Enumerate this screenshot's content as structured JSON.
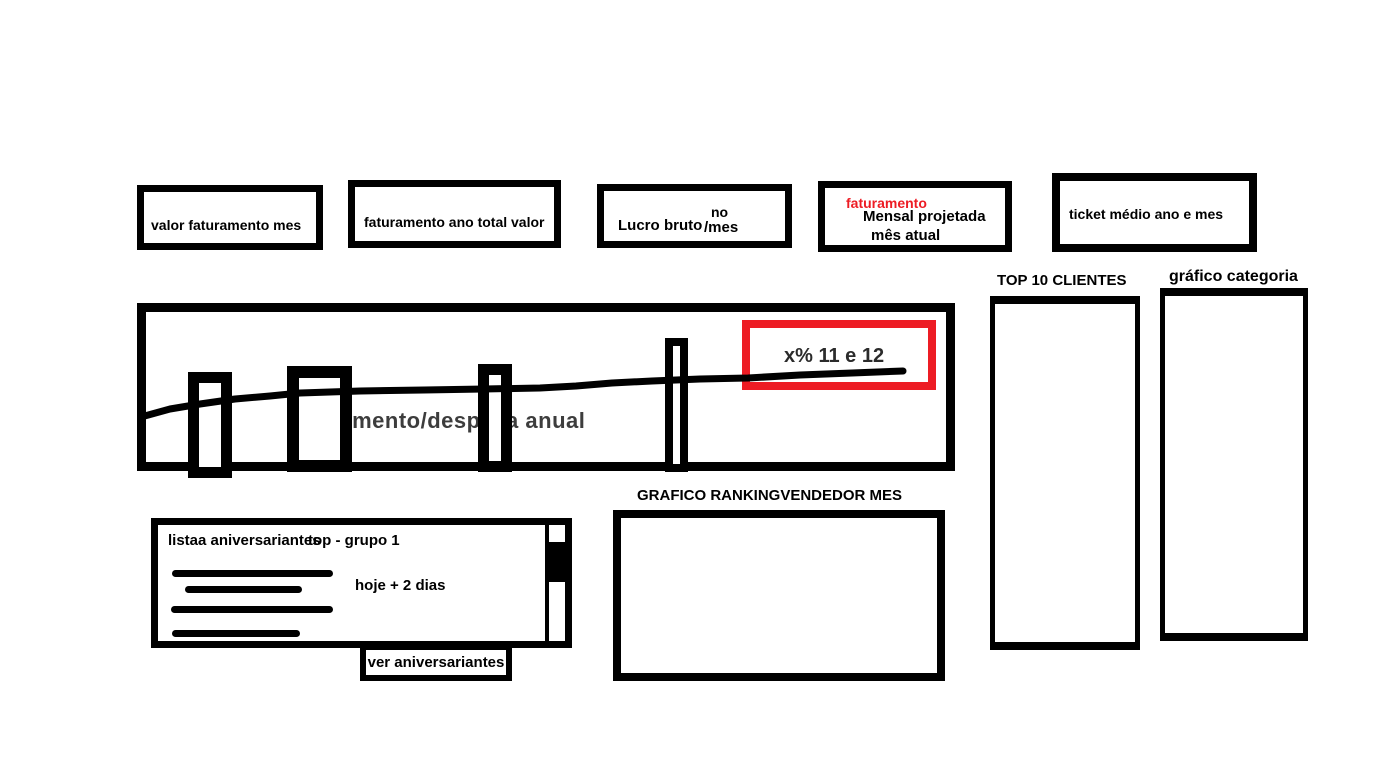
{
  "palette": {
    "background": "#ffffff",
    "ink": "#000000",
    "red": "#ed1c24",
    "chart_text": "#3d3d3d"
  },
  "kpi_cards": {
    "valor_mes": {
      "label": "valor faturamento mes"
    },
    "ano_total": {
      "label": "faturamento ano total valor"
    },
    "lucro_bruto": {
      "word1": "Lucro",
      "word2": "bruto",
      "sup": "no",
      "fraction": "/mes"
    },
    "faturamento_projetado": {
      "line1_red": "faturamento",
      "line2": "Mensal projetada",
      "line3": "mês atual"
    },
    "ticket_medio": {
      "label": "ticket médio ano e mes"
    }
  },
  "annual_chart": {
    "title": "faturamento/despesa anual",
    "callout_label": "x% 11 e 12"
  },
  "top_clients": {
    "heading": "TOP 10 CLIENTES"
  },
  "category_chart": {
    "heading": "gráfico categoria"
  },
  "vendor_ranking": {
    "heading": "GRAFICO RANKINGVENDEDOR MES"
  },
  "birthday_list": {
    "title": "listaa aniversariantes",
    "group_label": "top - grupo 1",
    "range_note": "hoje + 2 dias",
    "view_button": "ver aniversariantes",
    "placeholder_rows": 4
  }
}
